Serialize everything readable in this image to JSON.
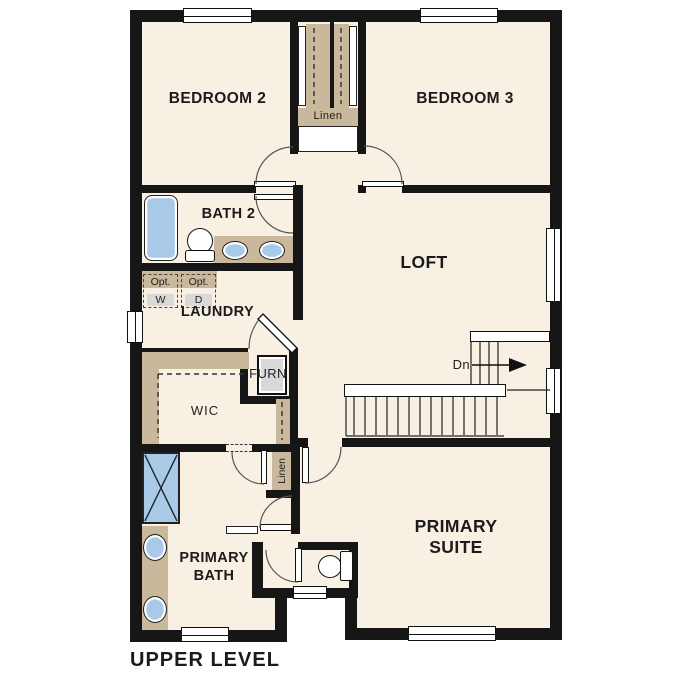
{
  "plan_title": "UPPER LEVEL",
  "labels": {
    "bedroom2": "BEDROOM 2",
    "bedroom3": "BEDROOM 3",
    "bath2": "BATH 2",
    "laundry": "LAUNDRY",
    "loft": "LOFT",
    "wic": "WIC",
    "furnace": "FURN",
    "hall_linen": "Linen",
    "primary_linen": "Linen",
    "washer_opt": "Opt.",
    "washer": "W",
    "dryer_opt": "Opt.",
    "dryer": "D",
    "stairs_down": "Dn",
    "primary_bath_1": "PRIMARY",
    "primary_bath_2": "BATH",
    "primary_suite_1": "PRIMARY",
    "primary_suite_2": "SUITE"
  },
  "colors": {
    "floor": "#f8f0e3",
    "wall": "#161616",
    "casework": "#cab89c",
    "fixture_blue": "#a9c9e9",
    "appliance_gray": "#d9d9d9"
  }
}
